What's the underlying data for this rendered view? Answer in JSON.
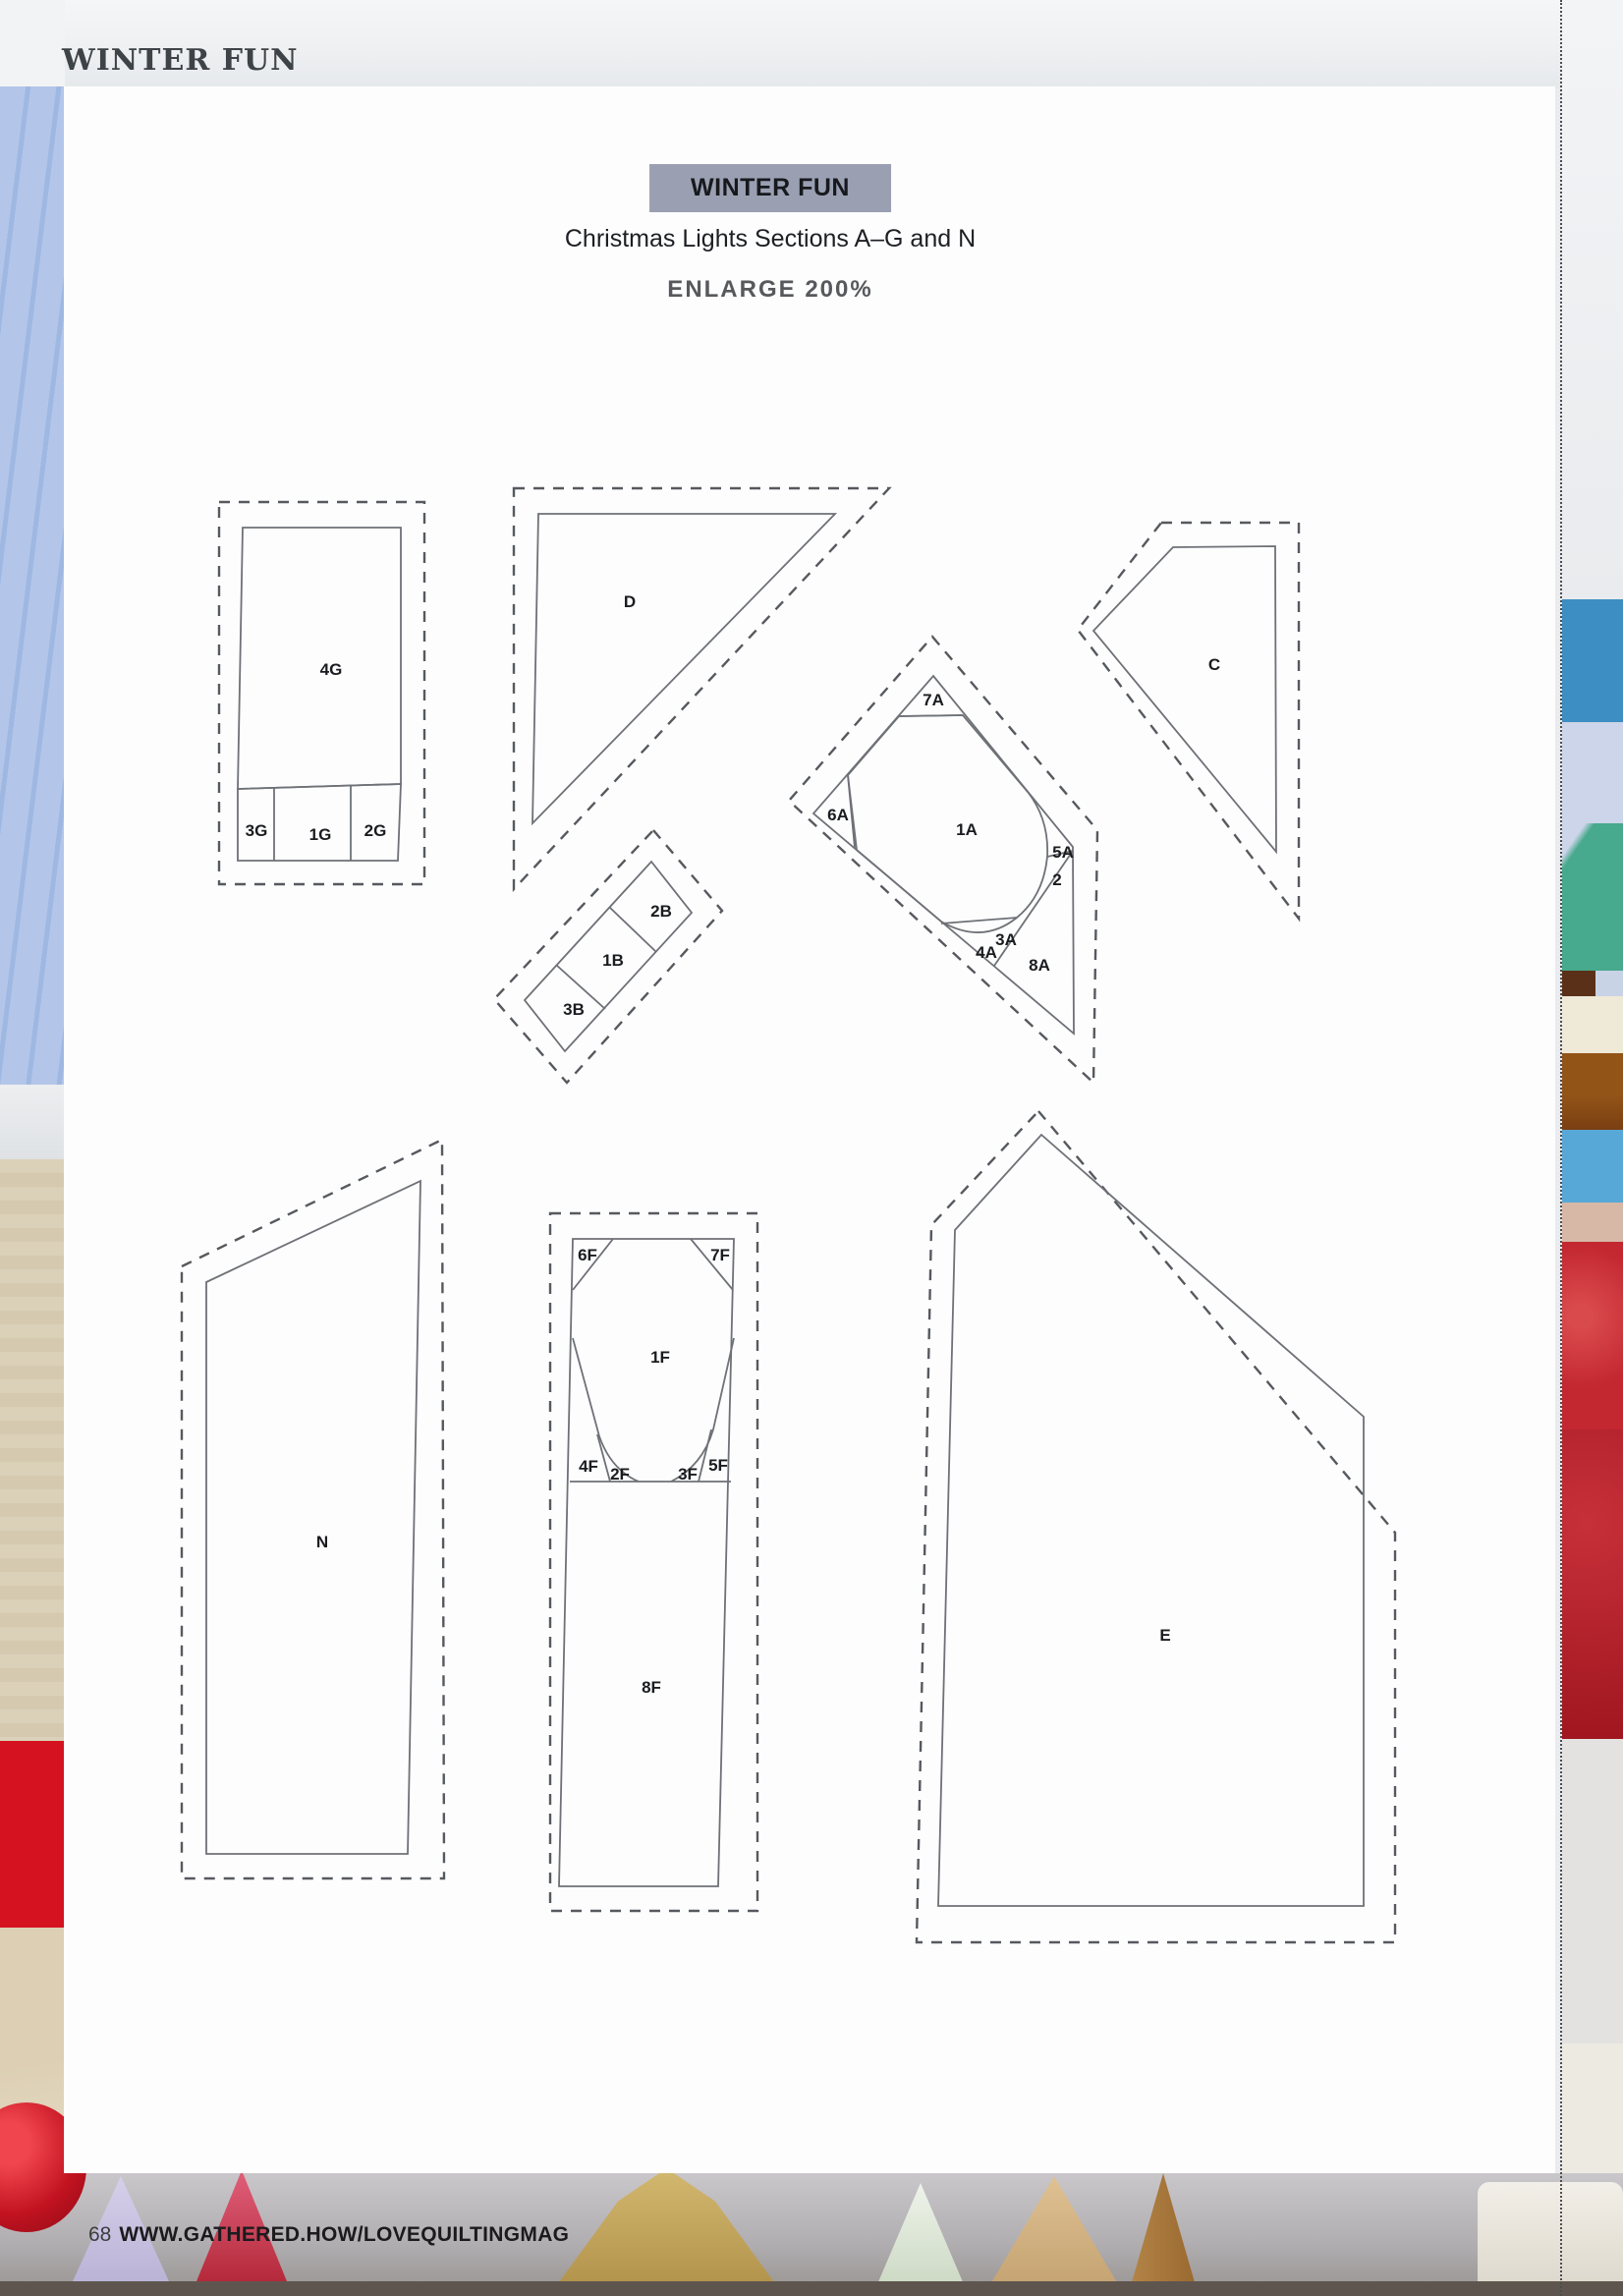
{
  "page": {
    "eyebrow": "WINTER FUN",
    "footer": {
      "page_number": "68",
      "url": "WWW.GATHERED.HOW/LOVEQUILTINGMAG"
    }
  },
  "panel": {
    "tag": "WINTER FUN",
    "title": "Christmas Lights Sections A–G and N",
    "note": "ENLARGE 200%"
  },
  "colors": {
    "tag_bg": "#9aa0b2",
    "solid_line": "#6e7176",
    "dashed_line": "#56595d",
    "label_text": "#1a1c1f",
    "eyebrow_text": "#3e4347"
  },
  "labels": {
    "g4": "4G",
    "g3": "3G",
    "g1": "1G",
    "g2": "2G",
    "d": "D",
    "c": "C",
    "a7": "7A",
    "a6": "6A",
    "a1": "1A",
    "a5": "5A",
    "a2": "2",
    "a3": "3A",
    "a4": "4A",
    "a8": "8A",
    "b2": "2B",
    "b1": "1B",
    "b3": "3B",
    "n": "N",
    "f6": "6F",
    "f7": "7F",
    "f1": "1F",
    "f4": "4F",
    "f2": "2F",
    "f3": "3F",
    "f5": "5F",
    "f8": "8F",
    "e": "E"
  }
}
